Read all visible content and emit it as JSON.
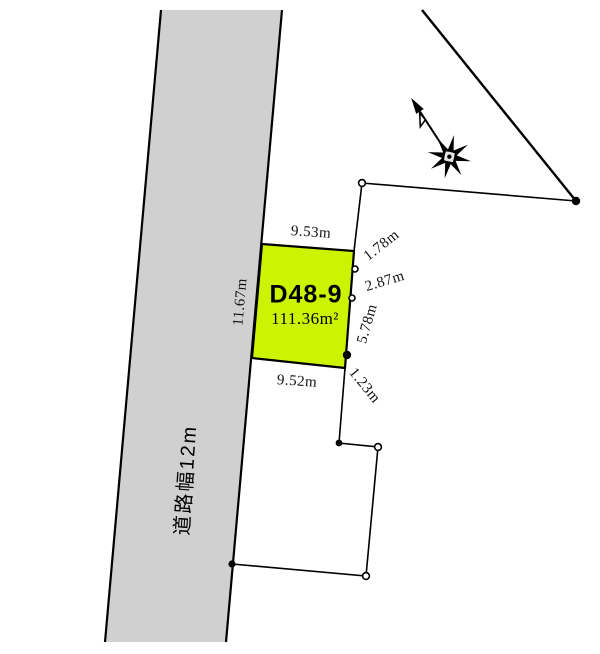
{
  "parcel": {
    "id": "D48-9",
    "area": "111.36m²"
  },
  "dimensions": {
    "top": "9.53m",
    "left": "11.67m",
    "bottom": "9.52m",
    "right_1": "1.78m",
    "right_2": "2.87m",
    "right_3": "5.78m",
    "right_4": "1.23m"
  },
  "road": {
    "label": "道路幅12m"
  },
  "colors": {
    "parcel_fill": "#ccf402",
    "road_fill": "#d0d0d0",
    "line": "#000000"
  },
  "icons": {
    "compass": "compass-north-arrow"
  }
}
